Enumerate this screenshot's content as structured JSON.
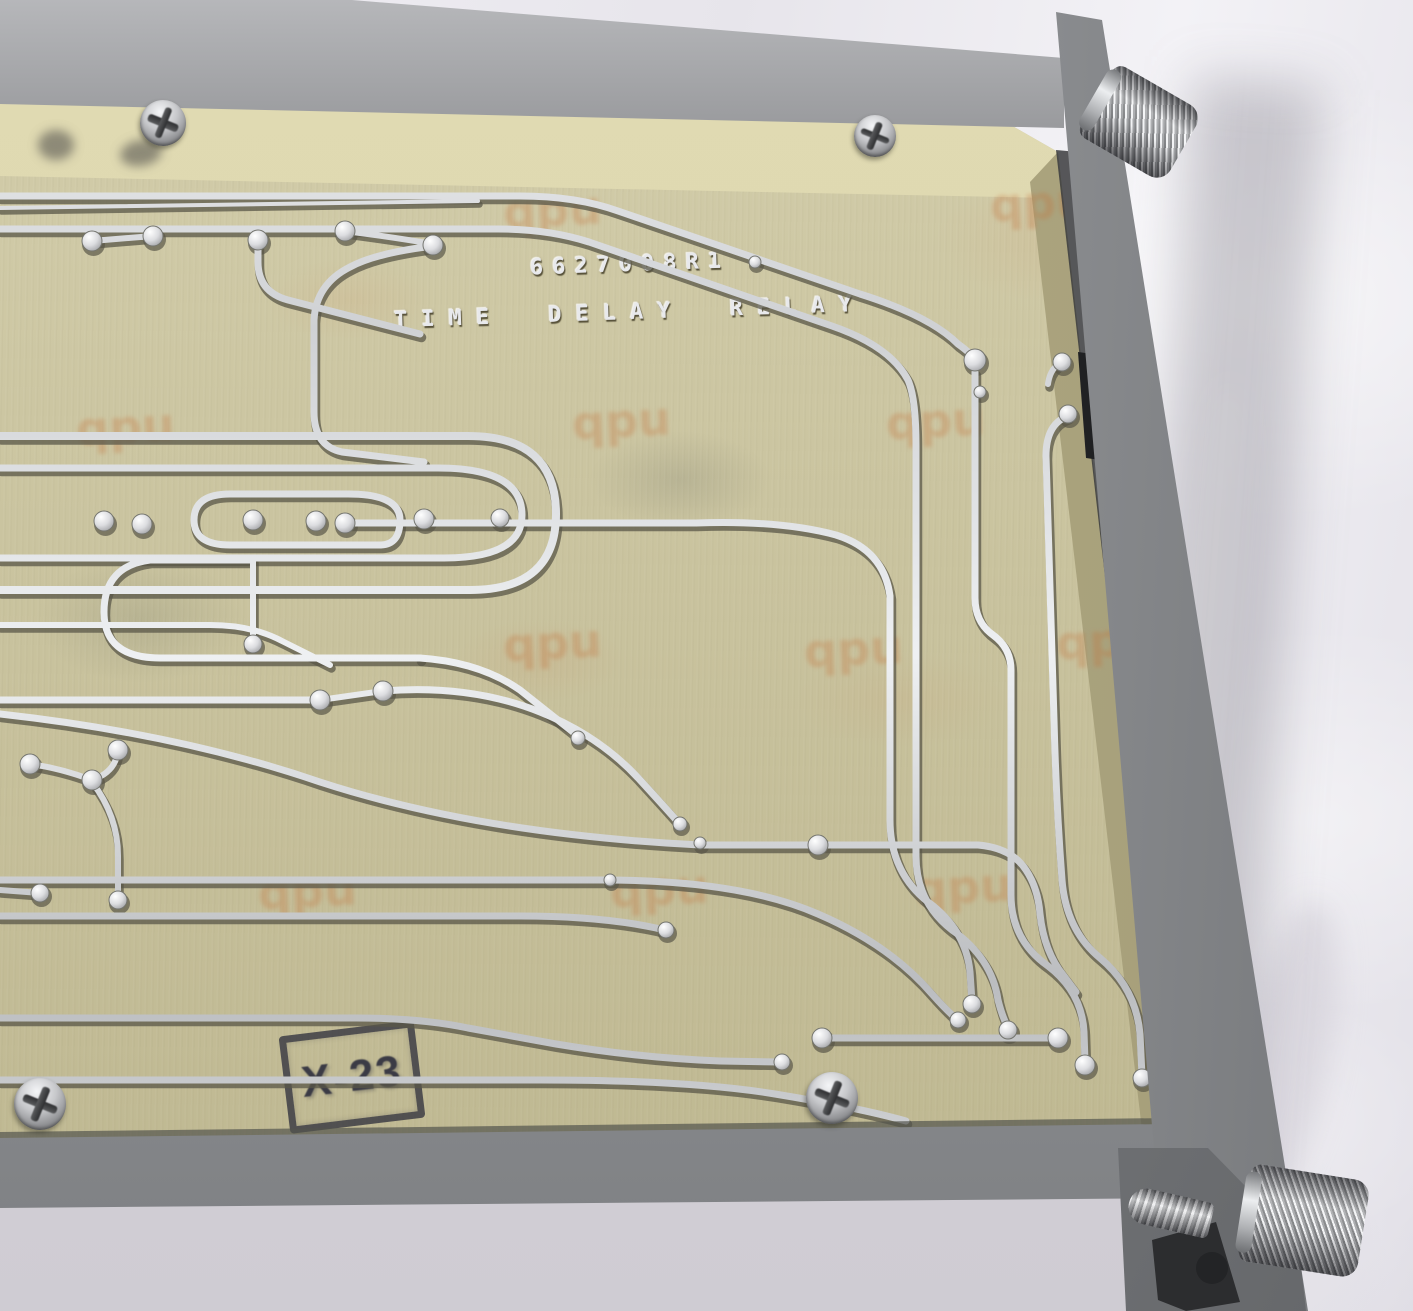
{
  "board": {
    "part_number": "6627008R1",
    "title": "TIME DELAY RELAY",
    "inspection_stamp": "X-23",
    "watermark": "qpu"
  },
  "colors": {
    "board_substrate": "#c8c199",
    "board_bevel": "#d9d3ab",
    "trace_silver": "#dfe1e4",
    "chassis_gray": "#8f9194",
    "chassis_dark": "#4b4d50",
    "background_sheet": "#edebf1",
    "stamp_ink": "#3b3b45",
    "watermark_orange": "#c07038",
    "etched_text_silver": "#e8e9ec"
  }
}
